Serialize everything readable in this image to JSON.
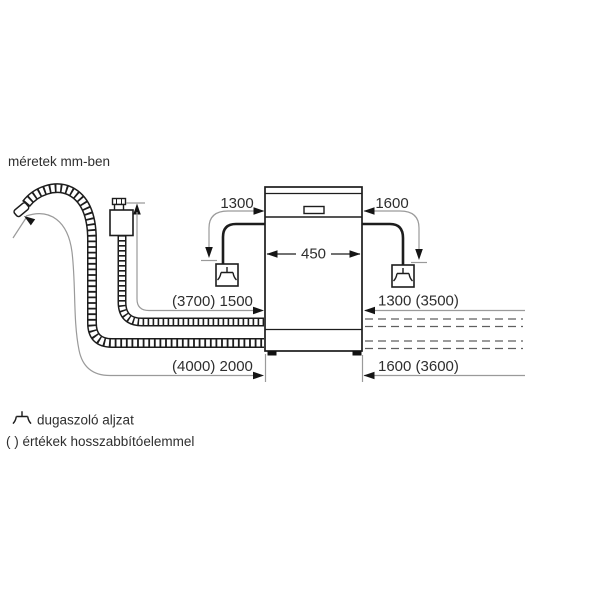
{
  "title": "méretek mm-ben",
  "diagram": {
    "appliance": "dishwasher-front-view",
    "top_dimensions": {
      "left_cord": "1300",
      "right_cord": "1600",
      "appliance_width": "450"
    },
    "left_dimensions": {
      "supply_hose": "(3700) 1500",
      "drain_hose": "(4000) 2000"
    },
    "right_dimensions": {
      "supply_hose": "1300 (3500)",
      "drain_hose": "1600 (3600)"
    },
    "icons": {
      "socket_icon": "plug-socket-icon",
      "hose_left": "drain-hose-corrugated",
      "hose_supply": "supply-hose-aquastop"
    }
  },
  "legend": {
    "socket_symbol": "plug-socket-icon",
    "socket_label": "dugaszoló aljzat",
    "brackets_label": "( ) értékek hosszabbítóelemmel"
  },
  "colors": {
    "background": "#ffffff",
    "line": "#1d1d1d",
    "leader": "#9a9a9a",
    "text": "#2e2e2e"
  }
}
